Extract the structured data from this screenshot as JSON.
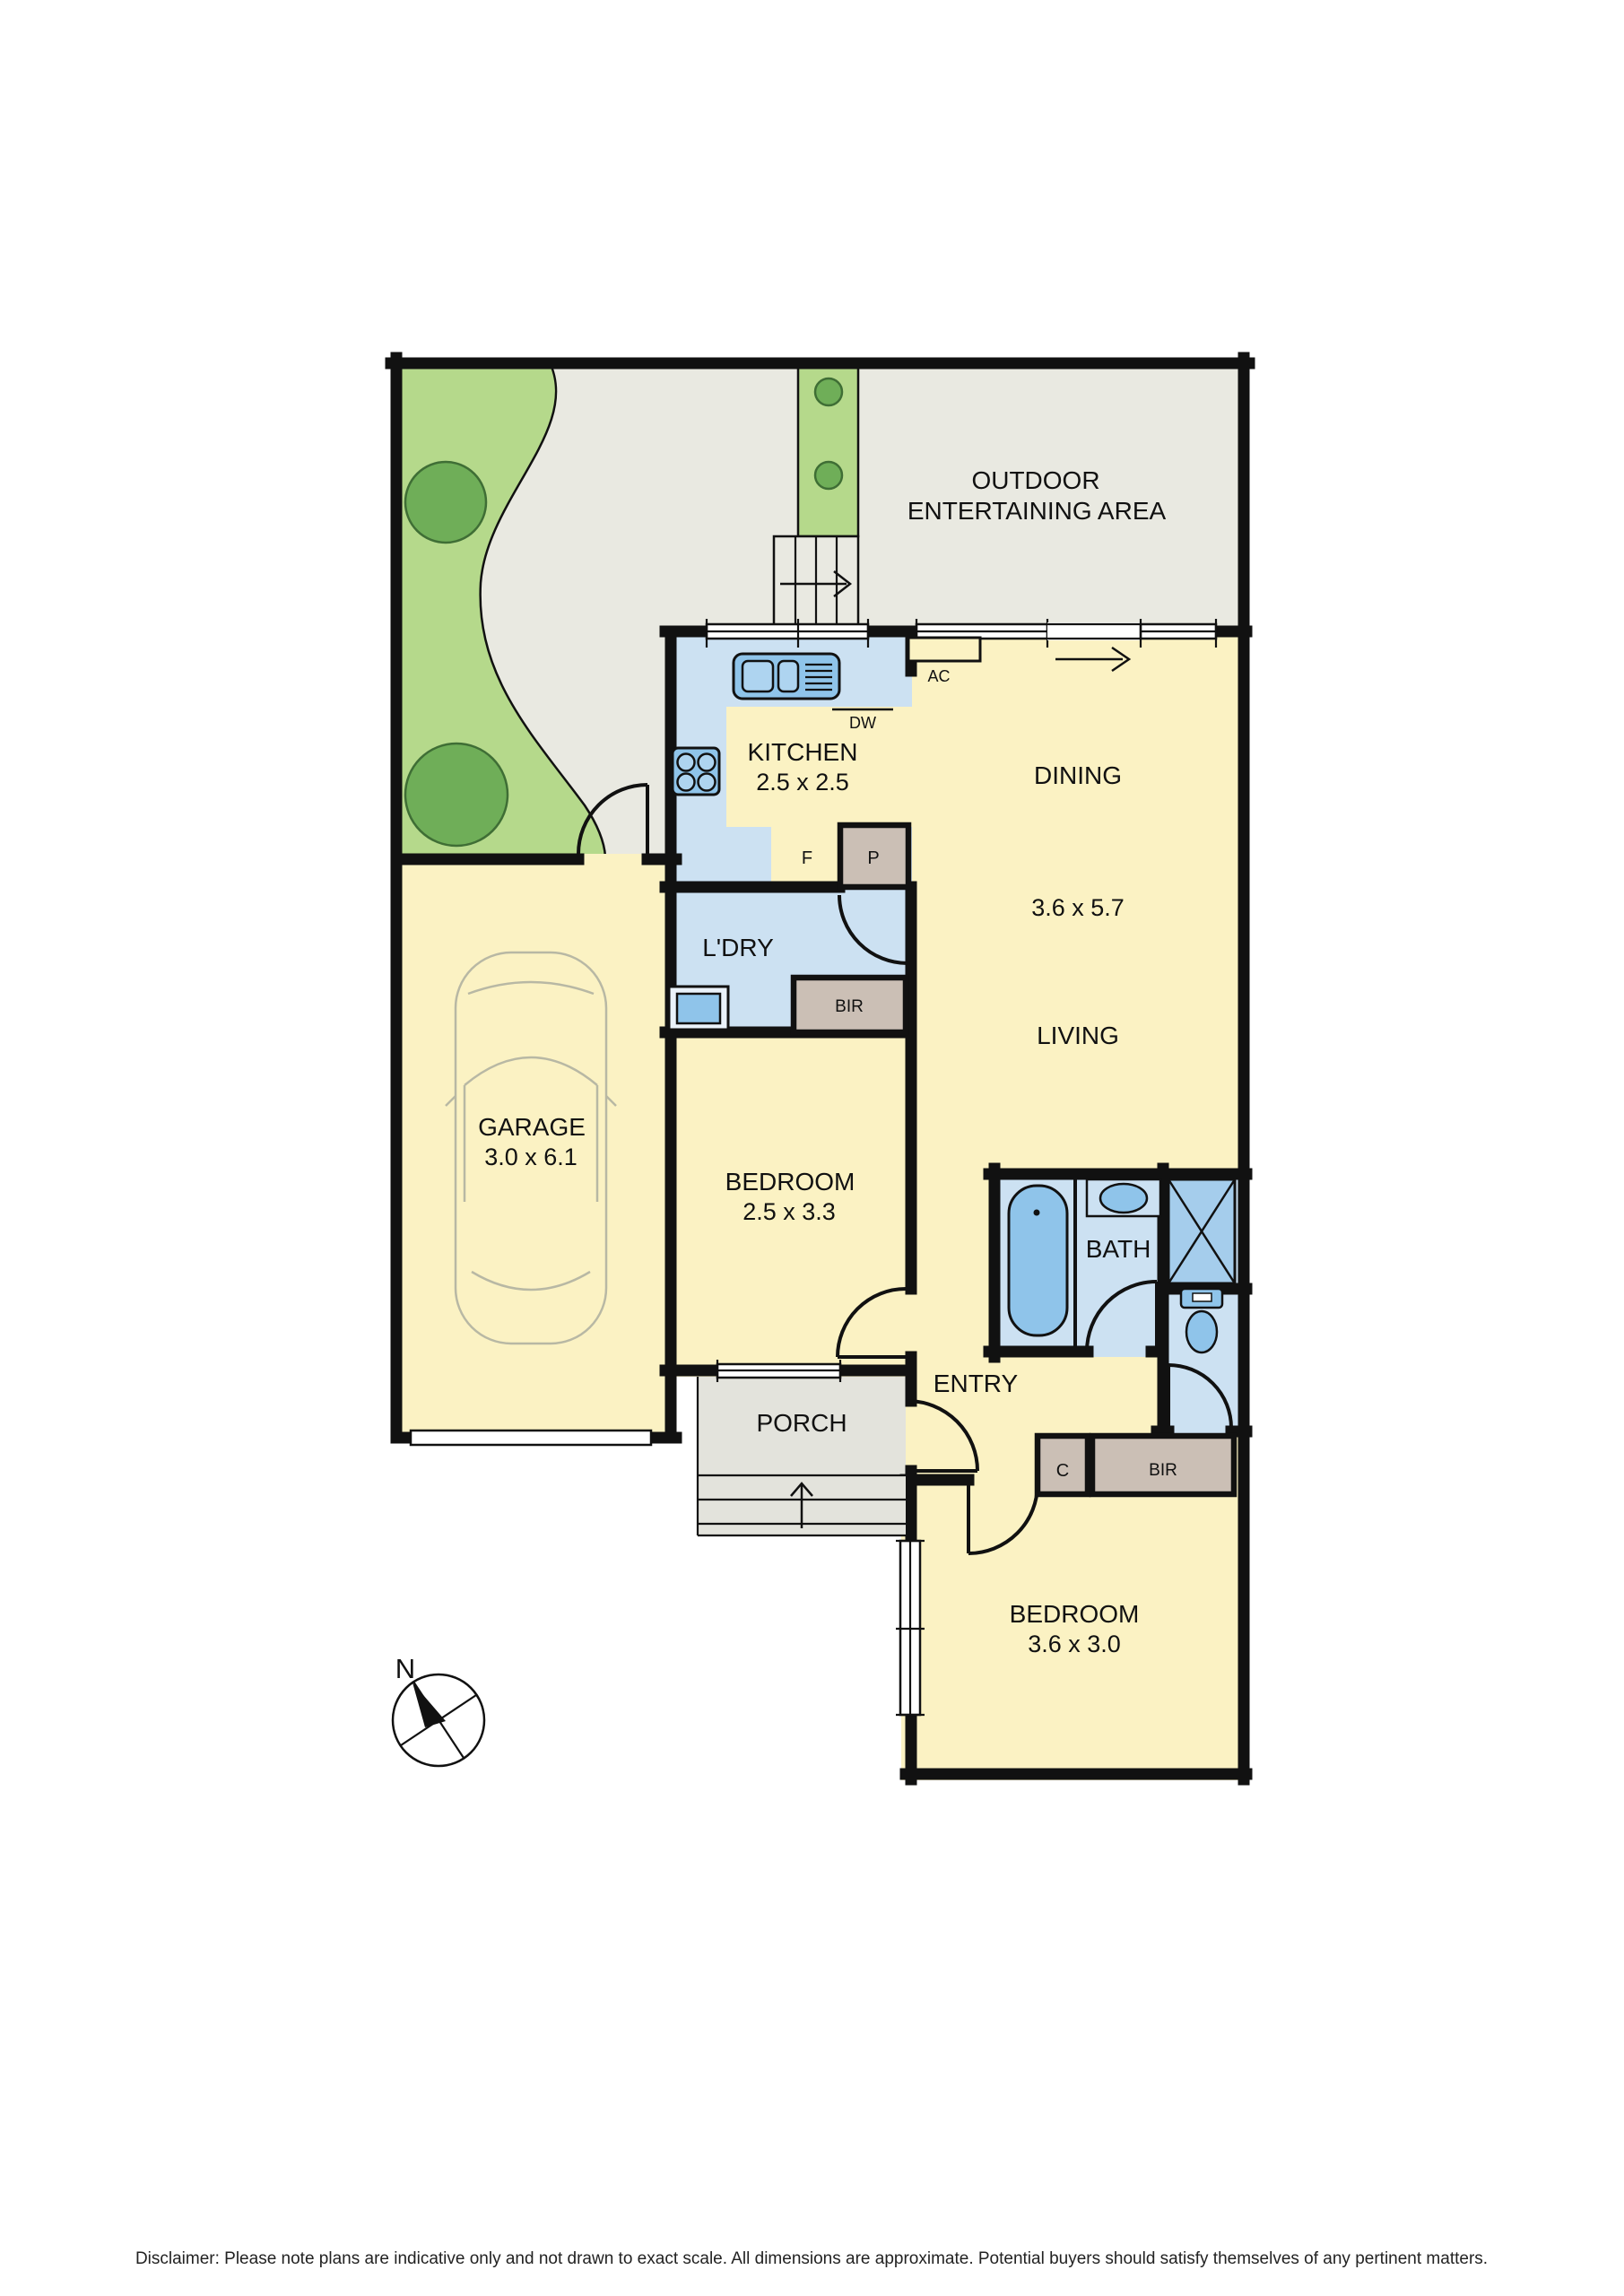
{
  "document": {
    "type": "residential floor plan"
  },
  "colors": {
    "wall": "#111111",
    "room_yellow": "#FBF2C3",
    "wet_area_blue": "#CCE1F2",
    "fixture_blue": "#8FC4EA",
    "fixture_blue_light": "#AED4F0",
    "shower_blue": "#A5CDEC",
    "robe_taupe": "#CBBFB5",
    "outdoor_grey": "#E9E9E1",
    "porch_grey": "#E3E3DC",
    "garden_green": "#B5D98B",
    "tree_green": "#6FAE58",
    "car_outline": "#B8B8A4"
  },
  "labels": {
    "outdoor_line1": "OUTDOOR",
    "outdoor_line2": "ENTERTAINING AREA",
    "kitchen": "KITCHEN",
    "kitchen_dims": "2.5 x 2.5",
    "dining": "DINING",
    "living_dining_dims": "3.6 x 5.7",
    "living": "LIVING",
    "laundry": "L'DRY",
    "dishwasher": "DW",
    "fridge": "F",
    "pantry": "P",
    "ac": "AC",
    "robe_laundry": "BIR",
    "garage": "GARAGE",
    "garage_dims": "3.0 x 6.1",
    "bedroom_mid": "BEDROOM",
    "bedroom_mid_dims": "2.5 x 3.3",
    "bath": "BATH",
    "entry": "ENTRY",
    "porch": "PORCH",
    "cupboard": "C",
    "robe_entry": "BIR",
    "bedroom_rear": "BEDROOM",
    "bedroom_rear_dims": "3.6 x 3.0",
    "north": "N"
  },
  "rooms": [
    {
      "name": "OUTDOOR ENTERTAINING AREA",
      "dims": ""
    },
    {
      "name": "KITCHEN",
      "dims": "2.5 x 2.5"
    },
    {
      "name": "DINING",
      "dims": "3.6 x 5.7"
    },
    {
      "name": "LIVING",
      "dims": "3.6 x 5.7"
    },
    {
      "name": "L'DRY",
      "dims": ""
    },
    {
      "name": "GARAGE",
      "dims": "3.0 x 6.1"
    },
    {
      "name": "BEDROOM",
      "dims": "2.5 x 3.3"
    },
    {
      "name": "BATH",
      "dims": ""
    },
    {
      "name": "ENTRY",
      "dims": ""
    },
    {
      "name": "PORCH",
      "dims": ""
    },
    {
      "name": "BEDROOM",
      "dims": "3.6 x 3.0"
    }
  ],
  "fixture_icons": [
    "sink-icon",
    "dishwasher-label",
    "cooktop-icon",
    "fridge-label",
    "pantry-box",
    "laundry-trough-icon",
    "built-in-robe-box",
    "bathtub-icon",
    "vanity-basin-icon",
    "shower-icon",
    "toilet-icon",
    "car-icon",
    "stairs-icon",
    "steps-icon",
    "north-compass-icon",
    "tree-icon",
    "door-swing-icon",
    "window-icon",
    "direction-arrow-icon"
  ],
  "footer": {
    "disclaimer": "Disclaimer: Please note plans are indicative only and not drawn to exact scale. All dimensions are approximate. Potential buyers should satisfy themselves of any pertinent matters."
  }
}
